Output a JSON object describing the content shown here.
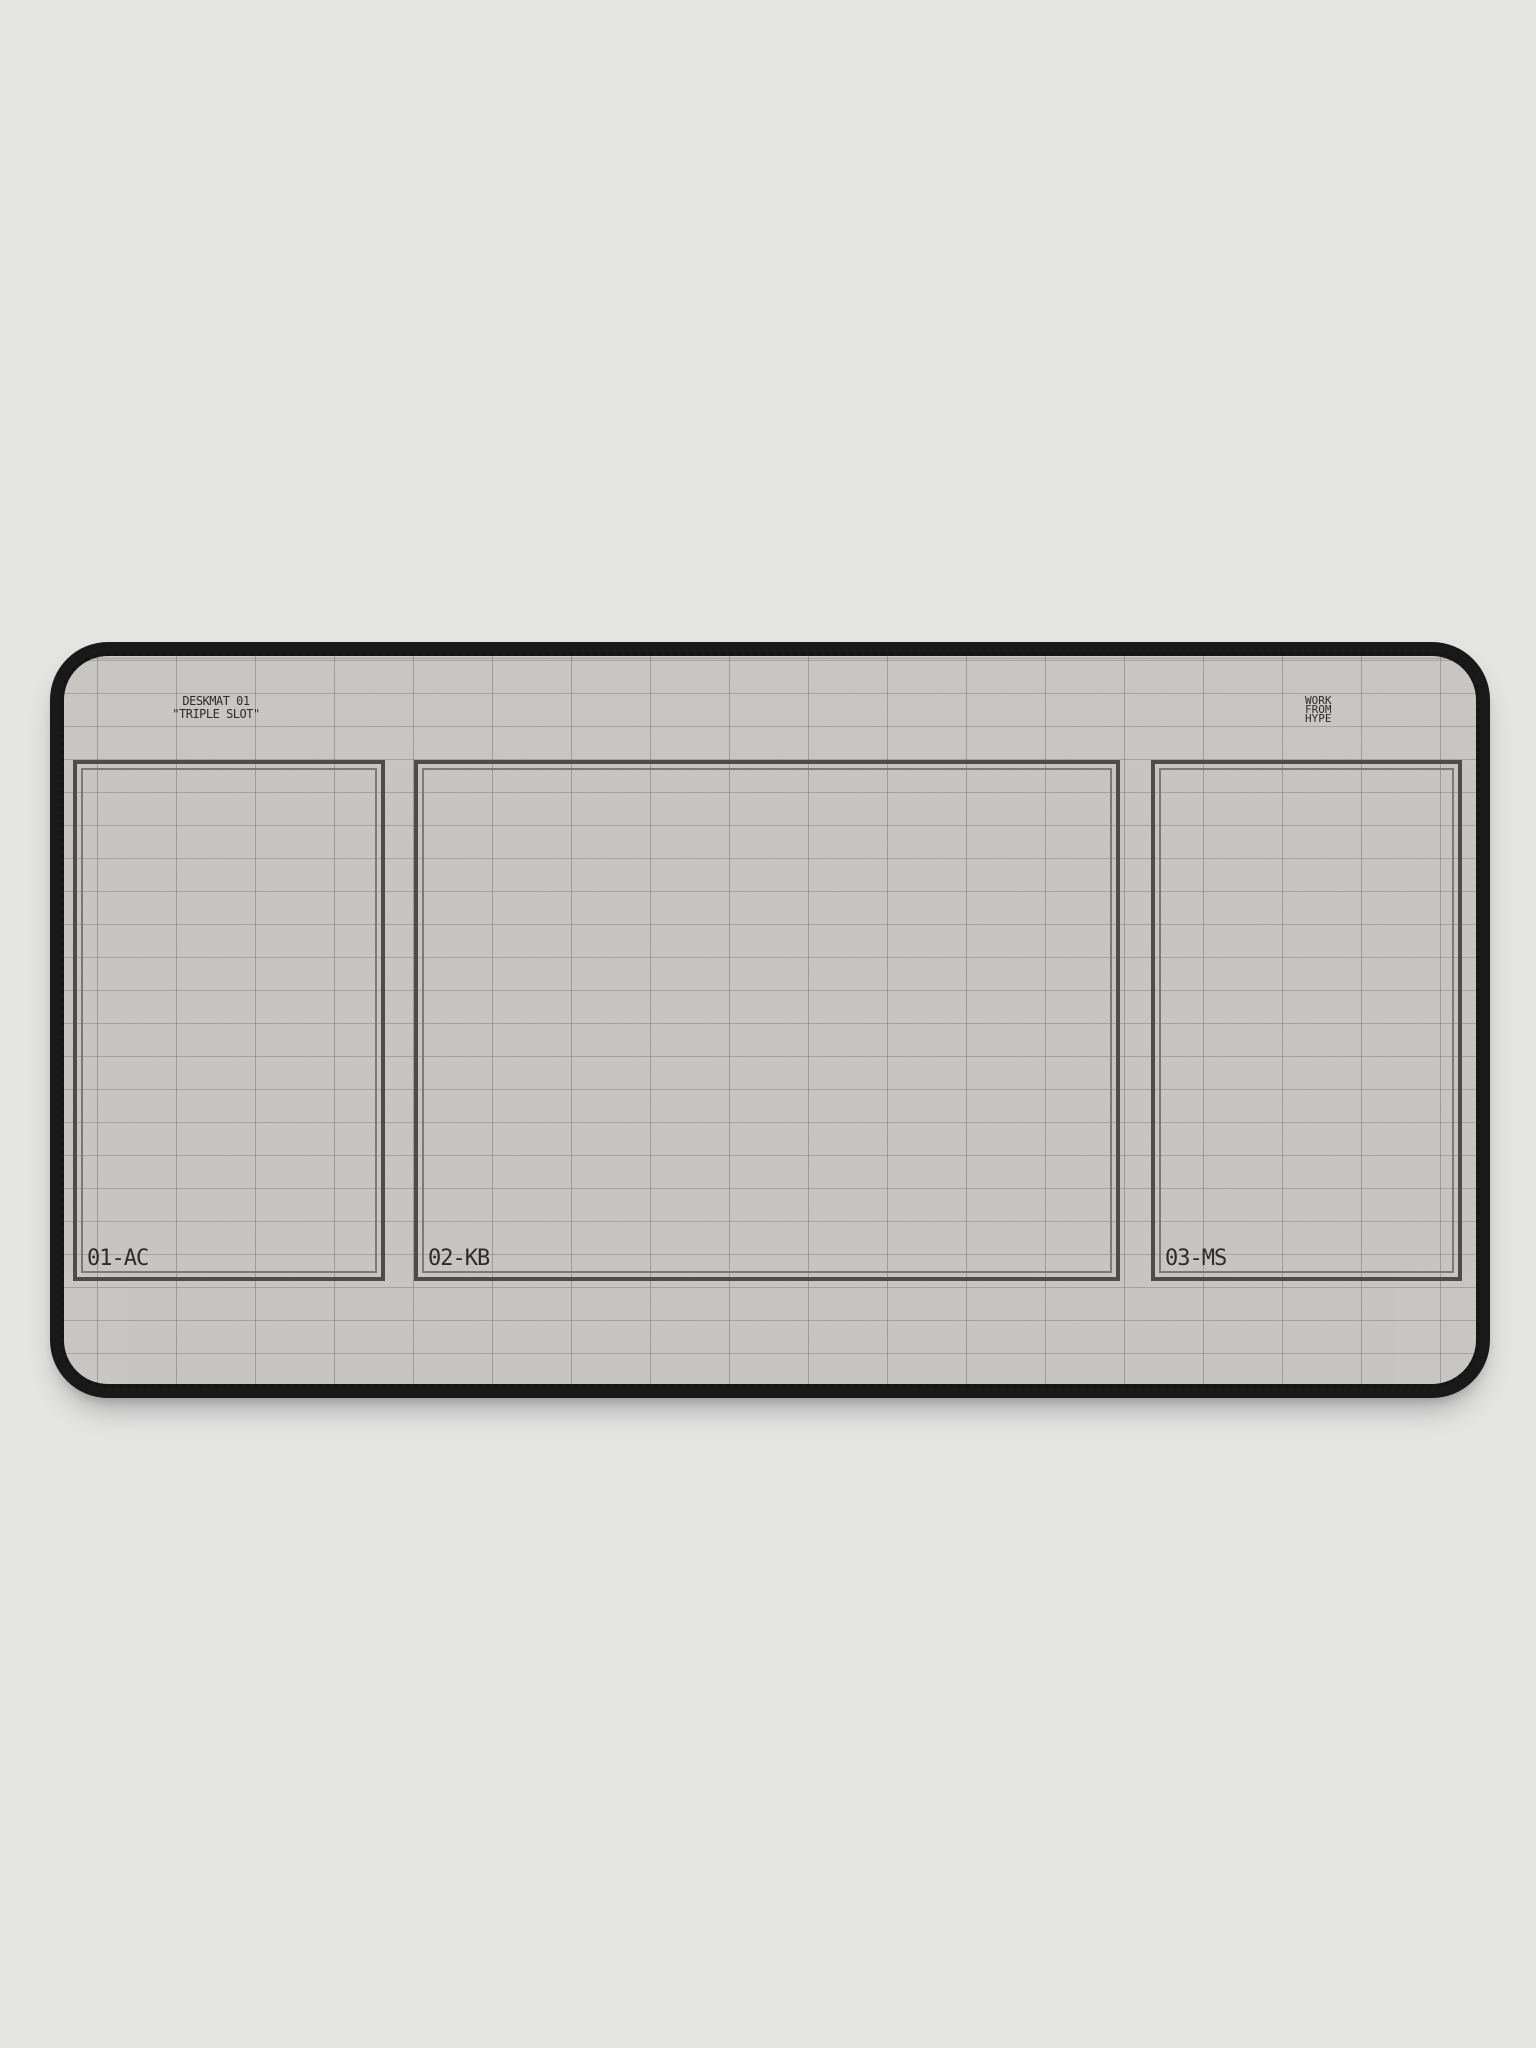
{
  "mat": {
    "title": {
      "line1": "DESKMAT 01",
      "line2": "\"TRIPLE SLOT\""
    },
    "brand": {
      "line1": "WORK",
      "line2": "FROM",
      "line3": "HYPE"
    },
    "zones": [
      {
        "label": "01-AC"
      },
      {
        "label": "02-KB"
      },
      {
        "label": "03-MS"
      }
    ],
    "colors": {
      "page_background": "#e4e4e3",
      "edge_binding": "#191919",
      "fabric_surface": "#ebe9e6",
      "grid_line": "#b9b6b2",
      "zone_frame_outer": "#4d4c4a",
      "zone_frame_inner": "#7c7a77",
      "print_text": "#2d2c2a"
    }
  }
}
